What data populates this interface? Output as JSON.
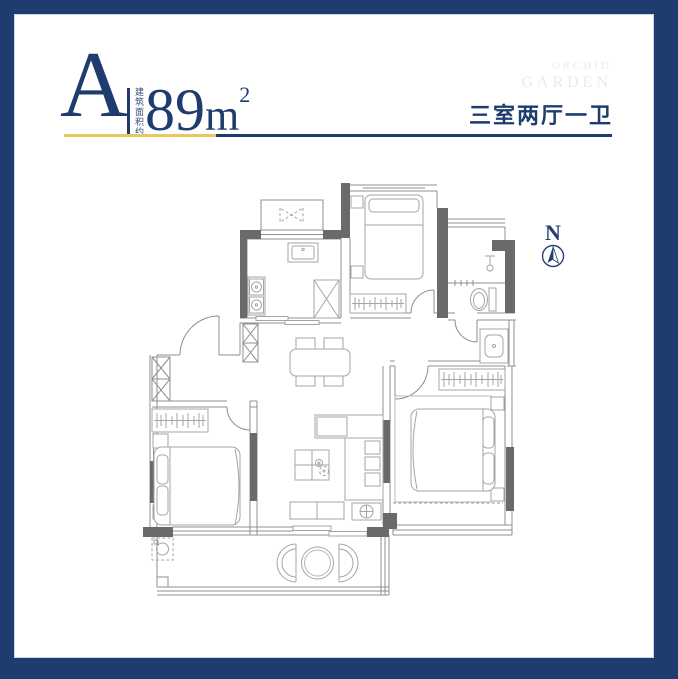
{
  "frame": {
    "color": "#1e3c6e"
  },
  "header": {
    "unit_label": "A",
    "area_prefix": "建筑面积约",
    "area_value": "89",
    "area_unit": "m",
    "area_exponent": "2",
    "layout_text": "三室两厅一卫",
    "divider_gold_color": "#e9c85e",
    "divider_navy_color": "#1e3c6e"
  },
  "watermark": {
    "line1": "ORCHID",
    "line2": "GARDEN",
    "color": "#eaeaee"
  },
  "compass": {
    "label": "N",
    "color": "#24406f"
  },
  "floorplan": {
    "colors": {
      "wall": "#6a6a6a",
      "outline": "#8f8f8f",
      "furniture": "#a5a5a5"
    }
  }
}
